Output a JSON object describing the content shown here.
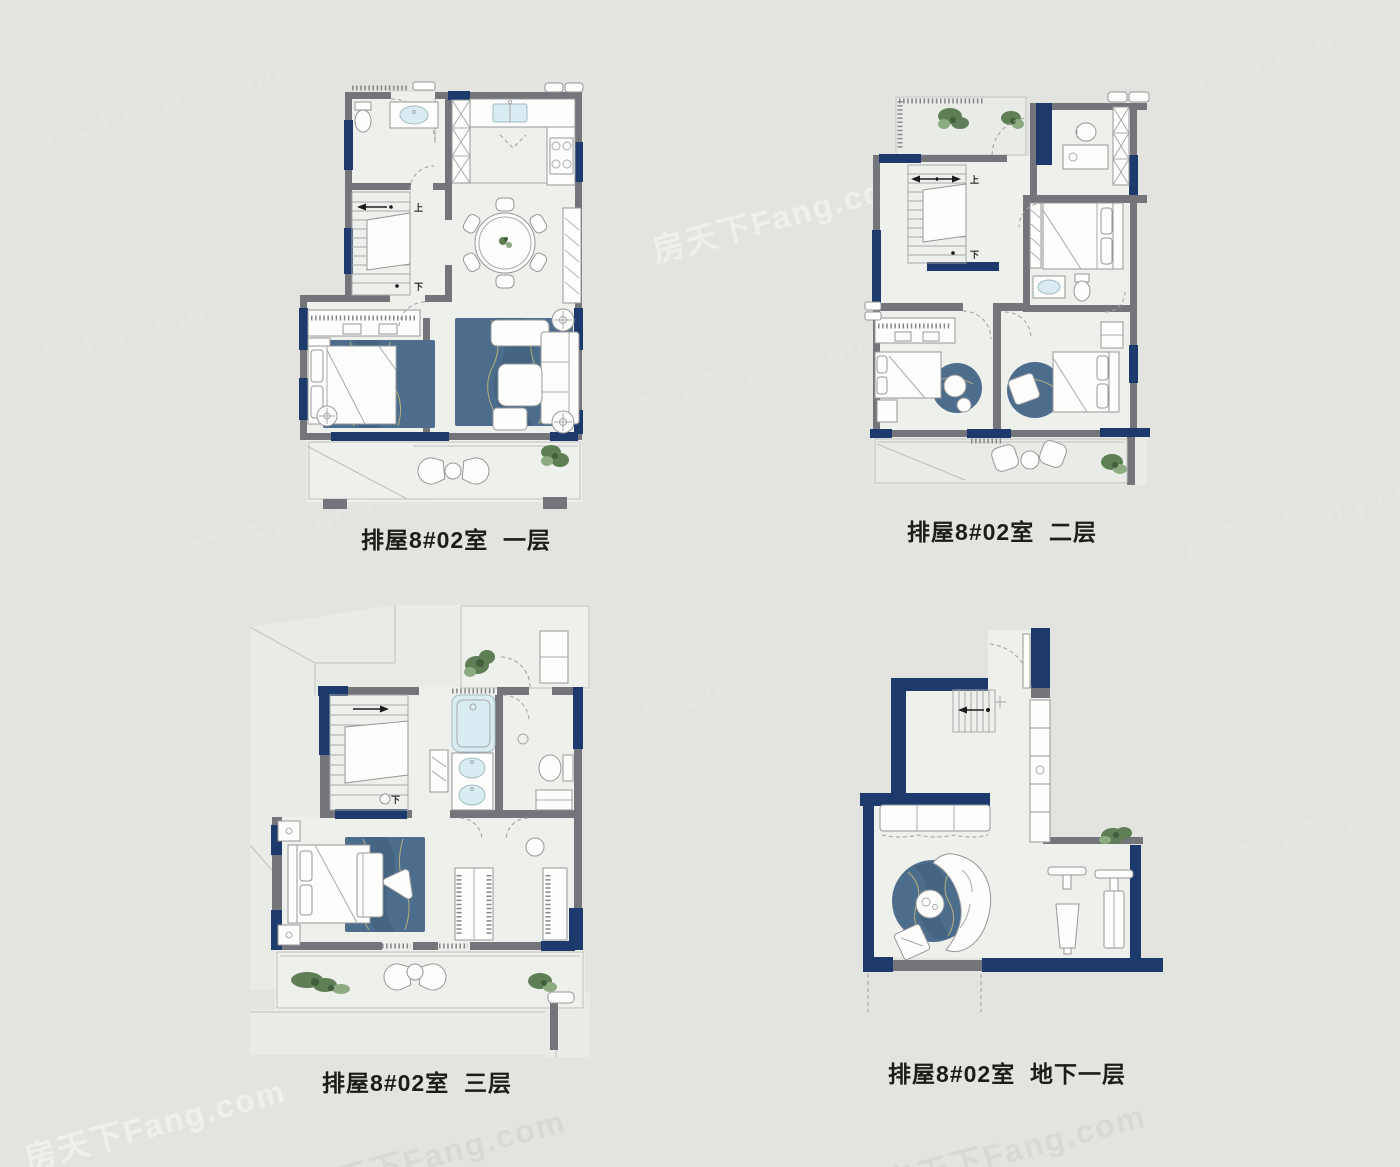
{
  "page": {
    "background": "#e3e4e0",
    "watermark_text": "房天下Fang.com"
  },
  "colors": {
    "wall_navy": "#1c3a6b",
    "wall_gray": "#74757a",
    "floor": "#eef0ec",
    "roof_terrace": "#e9ebe7",
    "rug_blue": "#4d6d8c",
    "rug_vein_gold": "#c9b879",
    "water_cyan": "#d9ecf1",
    "plant_green": "#5e7f55",
    "furniture_white": "#fdfdfc",
    "furniture_outline": "#96979a",
    "caption_color": "#1c1c1a"
  },
  "stairs_labels": {
    "up": "上",
    "down": "下"
  },
  "plans": [
    {
      "id": "floor-1",
      "caption": "排屋8#02室  一层"
    },
    {
      "id": "floor-2",
      "caption": "排屋8#02室  二层"
    },
    {
      "id": "floor-3",
      "caption": "排屋8#02室  三层"
    },
    {
      "id": "basement",
      "caption": "排屋8#02室  地下一层"
    }
  ]
}
